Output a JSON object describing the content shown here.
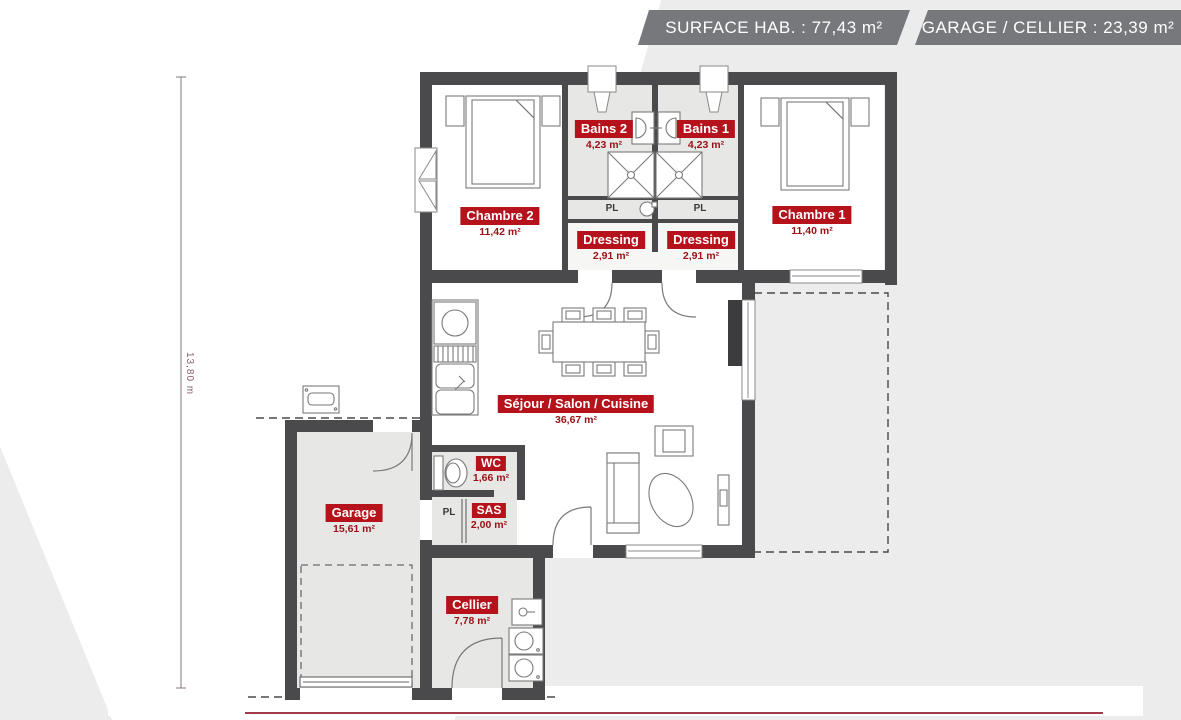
{
  "header": {
    "surface": "SURFACE HAB. : 77,43 m²",
    "garage": "GARAGE / CELLIER : 23,39 m²"
  },
  "plan": {
    "dimension_left": "13,80 m",
    "rooms": {
      "bains2": {
        "name": "Bains 2",
        "area": "4,23 m²"
      },
      "bains1": {
        "name": "Bains 1",
        "area": "4,23 m²"
      },
      "chambre2": {
        "name": "Chambre 2",
        "area": "11,42 m²"
      },
      "chambre1": {
        "name": "Chambre 1",
        "area": "11,40 m²"
      },
      "dressing_left": {
        "name": "Dressing",
        "area": "2,91 m²"
      },
      "dressing_right": {
        "name": "Dressing",
        "area": "2,91 m²"
      },
      "sejour": {
        "name": "Séjour / Salon / Cuisine",
        "area": "36,67 m²"
      },
      "wc": {
        "name": "WC",
        "area": "1,66 m²"
      },
      "sas": {
        "name": "SAS",
        "area": "2,00 m²"
      },
      "garage": {
        "name": "Garage",
        "area": "15,61 m²"
      },
      "cellier": {
        "name": "Cellier",
        "area": "7,78 m²"
      }
    },
    "closets": {
      "pl_bains_left": "PL",
      "pl_bains_right": "PL",
      "pl_sas": "PL"
    }
  },
  "colors": {
    "label_bg": "#b5121b",
    "label_text": "#ffffff",
    "area_text": "#9c1016",
    "wall": "#4a4a4c",
    "banner_bg": "#76787b",
    "accent_line": "#a23b49"
  }
}
